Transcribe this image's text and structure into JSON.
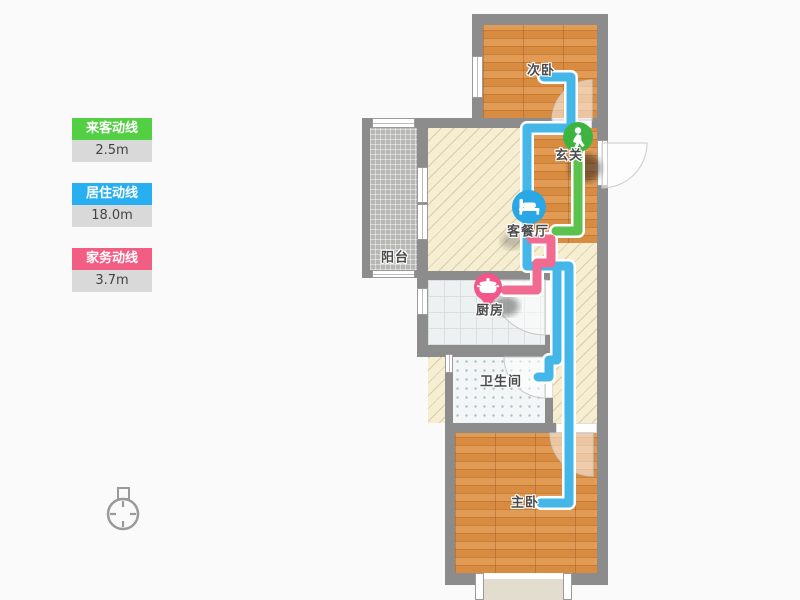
{
  "legend": {
    "items": [
      {
        "label": "来客动线",
        "value": "2.5m",
        "color": "#53cf44"
      },
      {
        "label": "居住动线",
        "value": "18.0m",
        "color": "#28aff2"
      },
      {
        "label": "家务动线",
        "value": "3.7m",
        "color": "#f25d83"
      }
    ]
  },
  "rooms": {
    "bedroom_second": {
      "label": "次卧"
    },
    "entry": {
      "label": "玄关"
    },
    "balcony": {
      "label": "阳台"
    },
    "living_dining": {
      "label": "客餐厅"
    },
    "kitchen": {
      "label": "厨房"
    },
    "bathroom": {
      "label": "卫生间"
    },
    "bedroom_master": {
      "label": "主卧"
    }
  },
  "paths": {
    "visitor": {
      "name": "来客动线",
      "color": "#5bc24d"
    },
    "living": {
      "name": "居住动线",
      "color": "#45b6e8"
    },
    "housework": {
      "name": "家务动线",
      "color": "#f16a8f"
    }
  },
  "markers": {
    "entry": {
      "icon": "walking-person-icon",
      "color": "#3eb440"
    },
    "living": {
      "icon": "bed-icon",
      "color": "#2aa7e5"
    },
    "kitchen": {
      "icon": "cooking-pot-icon",
      "color": "#f2568a"
    }
  }
}
